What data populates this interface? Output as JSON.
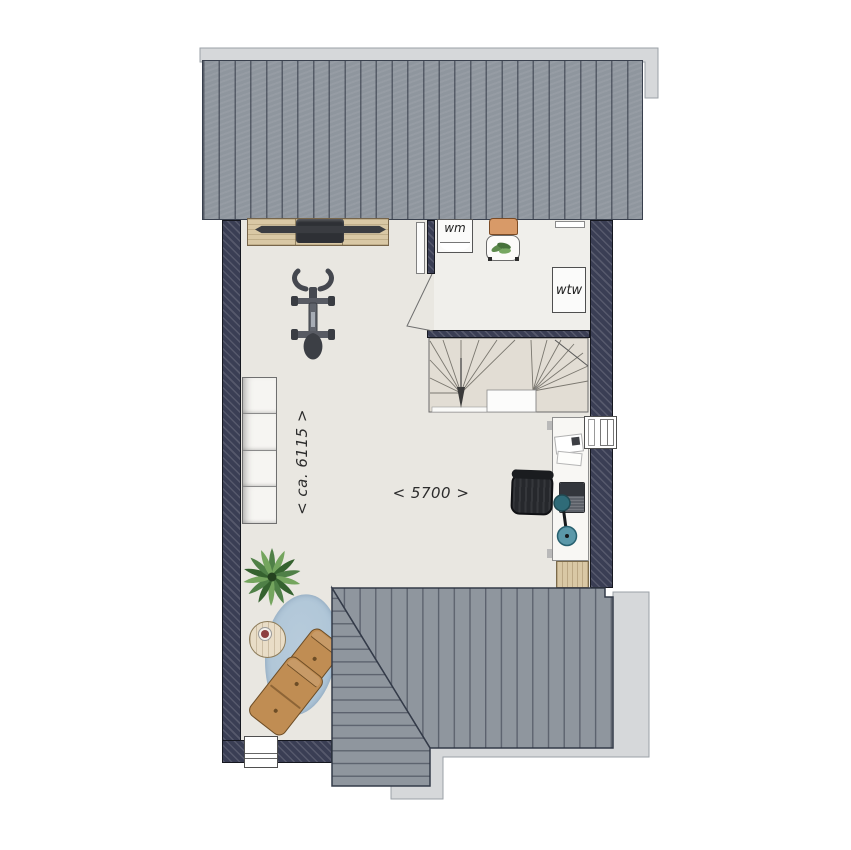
{
  "labels": {
    "washing_machine": "wm",
    "heat_recovery_unit": "wtw"
  },
  "dimensions": {
    "room_depth": "< ca. 6115 >",
    "room_width": "< 5700 >"
  },
  "colors": {
    "roof_surface": "#8f969e",
    "roof_line": "#2b3140",
    "roof_edge": "#d6d8da",
    "roof_edge_line": "#9ba1a7",
    "wall": "#3a3e54",
    "floor_main": "#e9e7e1",
    "floor_tech": "#f0efeb",
    "stair_floor": "#e2ddd4",
    "stair_line": "#6a6a6a",
    "landing": "#fcfcfb",
    "wood": "#d9c8a5",
    "wood_edge": "#77654a",
    "dark_object": "#2e3035",
    "rug": "#aec5d7",
    "armchair": "#c08d53",
    "armchair_edge": "#6d4d26",
    "plant": "#55824a",
    "lamp": "#2f6b78",
    "white_goods": "#fbfbfa",
    "seat_orange": "#d89a68"
  },
  "objects": [
    "roof-top",
    "workbench",
    "barbell-bar",
    "exercise-bike",
    "washing-machine",
    "chair-with-cushion",
    "ventilation-grille",
    "heat-recovery-unit",
    "door",
    "staircase",
    "stairs-down-arrow",
    "wardrobe",
    "desk",
    "office-chair",
    "laptop",
    "desk-lamp",
    "papers",
    "window-right",
    "plant",
    "side-table",
    "coffee-cup",
    "rug",
    "armchair-small",
    "armchair-large",
    "dresser",
    "window-bottom",
    "roof-bottom"
  ]
}
